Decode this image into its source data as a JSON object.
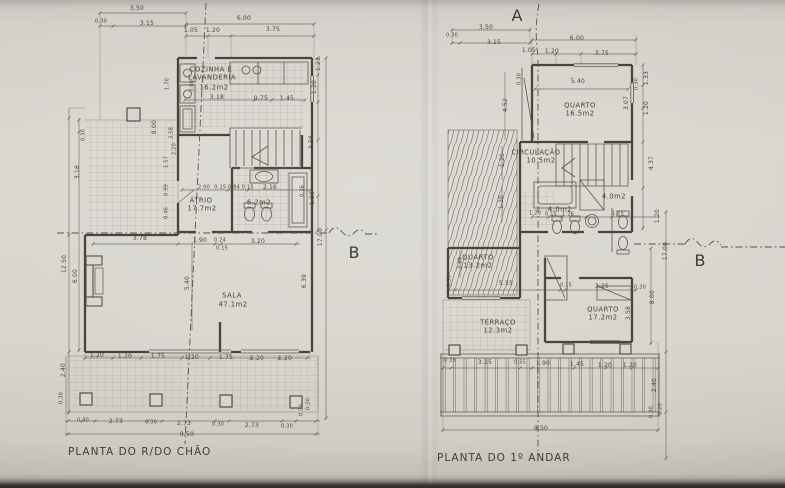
{
  "photo": {
    "paper_color": "#d7d4cd",
    "ink_color": "#4a453d",
    "table_edge_color": "#2b2926"
  },
  "ground_floor": {
    "caption": "PLANTA DO R/DO CHÃO",
    "labels": [
      {
        "t": "3.50",
        "x": 137,
        "y": 9
      },
      {
        "t": "0.30",
        "x": 101,
        "y": 22,
        "c": "sm"
      },
      {
        "t": "3.15",
        "x": 147,
        "y": 24
      },
      {
        "t": "6.00",
        "x": 244,
        "y": 19
      },
      {
        "t": "1.05",
        "x": 191,
        "y": 31
      },
      {
        "t": "1.20",
        "x": 213,
        "y": 31
      },
      {
        "t": "3.75",
        "x": 273,
        "y": 30
      },
      {
        "t": "1.70",
        "x": 168,
        "y": 84,
        "c": "rot sm"
      },
      {
        "t": "3.00",
        "x": 193,
        "y": 86,
        "c": "rot sm"
      },
      {
        "t": "COZINHA E",
        "x": 211,
        "y": 70,
        "c": "room",
        "n": "room-label"
      },
      {
        "t": "LAVANDERIA",
        "x": 212,
        "y": 78,
        "c": "room",
        "n": "room-label"
      },
      {
        "t": "16.2m2",
        "x": 214,
        "y": 88,
        "c": "room",
        "n": "room-area"
      },
      {
        "t": "3.18",
        "x": 217,
        "y": 98
      },
      {
        "t": "0.75",
        "x": 261,
        "y": 99
      },
      {
        "t": "1.45",
        "x": 287,
        "y": 99
      },
      {
        "t": "1.23",
        "x": 319,
        "y": 64,
        "c": "rot"
      },
      {
        "t": "1.20",
        "x": 315,
        "y": 87,
        "c": "rot"
      },
      {
        "t": "0.30",
        "x": 84,
        "y": 135,
        "c": "rot sm"
      },
      {
        "t": "3.18",
        "x": 78,
        "y": 172,
        "c": "rot"
      },
      {
        "t": "8.00",
        "x": 155,
        "y": 127,
        "c": "rot"
      },
      {
        "t": "3.58",
        "x": 172,
        "y": 133,
        "c": "rot sm"
      },
      {
        "t": "2.20",
        "x": 175,
        "y": 149,
        "c": "rot sm"
      },
      {
        "t": "1.57",
        "x": 167,
        "y": 162,
        "c": "rot sm"
      },
      {
        "t": "0.99",
        "x": 167,
        "y": 190,
        "c": "rot sm"
      },
      {
        "t": "0.46",
        "x": 167,
        "y": 213,
        "c": "rot sm"
      },
      {
        "t": "2.00",
        "x": 204,
        "y": 188,
        "c": "sm"
      },
      {
        "t": "0.15 0.84 0.15",
        "x": 234,
        "y": 188,
        "c": "sm"
      },
      {
        "t": "2.16",
        "x": 270,
        "y": 188
      },
      {
        "t": "ÁTRIO",
        "x": 201,
        "y": 201,
        "c": "room",
        "n": "room-label"
      },
      {
        "t": "17.7m2",
        "x": 202,
        "y": 209,
        "c": "room",
        "n": "room-area"
      },
      {
        "t": "6.2m2",
        "x": 259,
        "y": 203,
        "c": "room",
        "n": "room-area"
      },
      {
        "t": "3.58",
        "x": 312,
        "y": 142,
        "c": "rot"
      },
      {
        "t": "0.36",
        "x": 303,
        "y": 191,
        "c": "rot sm"
      },
      {
        "t": "1.20",
        "x": 313,
        "y": 198,
        "c": "rot"
      },
      {
        "t": "17.00",
        "x": 321,
        "y": 237,
        "c": "rot"
      },
      {
        "t": "6.39",
        "x": 305,
        "y": 281,
        "c": "rot"
      },
      {
        "t": "3.78",
        "x": 140,
        "y": 239
      },
      {
        "t": "1.90",
        "x": 200,
        "y": 241
      },
      {
        "t": "0.24",
        "x": 220,
        "y": 241,
        "c": "sm"
      },
      {
        "t": "3.20",
        "x": 258,
        "y": 242
      },
      {
        "t": "0.15",
        "x": 222,
        "y": 249,
        "c": "sm"
      },
      {
        "t": "12.50",
        "x": 65,
        "y": 264,
        "c": "rot"
      },
      {
        "t": "6.00",
        "x": 76,
        "y": 276,
        "c": "rot"
      },
      {
        "t": "5.40",
        "x": 188,
        "y": 283,
        "c": "rot"
      },
      {
        "t": "SALA",
        "x": 232,
        "y": 296,
        "c": "room",
        "n": "room-label"
      },
      {
        "t": "47.1m2",
        "x": 233,
        "y": 305,
        "c": "room",
        "n": "room-area"
      },
      {
        "t": "2.40",
        "x": 64,
        "y": 370,
        "c": "rot"
      },
      {
        "t": "0.30",
        "x": 62,
        "y": 398,
        "c": "rot sm"
      },
      {
        "t": "1.20",
        "x": 97,
        "y": 356
      },
      {
        "t": "1.20",
        "x": 125,
        "y": 357
      },
      {
        "t": "1.75",
        "x": 158,
        "y": 357
      },
      {
        "t": "1.20",
        "x": 192,
        "y": 358
      },
      {
        "t": "1.75",
        "x": 226,
        "y": 358
      },
      {
        "t": "1.20",
        "x": 257,
        "y": 359
      },
      {
        "t": "1.20",
        "x": 285,
        "y": 359
      },
      {
        "t": "0.20",
        "x": 309,
        "y": 404,
        "c": "rot sm"
      },
      {
        "t": "0.30",
        "x": 302,
        "y": 410,
        "c": "rot sm"
      },
      {
        "t": "0.30",
        "x": 83,
        "y": 421,
        "c": "sm"
      },
      {
        "t": "2.73",
        "x": 116,
        "y": 422
      },
      {
        "t": "0.30",
        "x": 151,
        "y": 423,
        "c": "sm"
      },
      {
        "t": "2.73",
        "x": 184,
        "y": 424
      },
      {
        "t": "0.30",
        "x": 218,
        "y": 425,
        "c": "sm"
      },
      {
        "t": "2.73",
        "x": 252,
        "y": 426
      },
      {
        "t": "0.30",
        "x": 287,
        "y": 427,
        "c": "sm"
      },
      {
        "t": "9.50",
        "x": 187,
        "y": 435
      },
      {
        "t": "B",
        "x": 354,
        "y": 253,
        "c": "section",
        "n": "section-marker-b"
      }
    ]
  },
  "first_floor": {
    "caption": "PLANTA DO 1º ANDAR",
    "labels": [
      {
        "t": "A",
        "x": 517,
        "y": 16,
        "c": "section",
        "n": "section-marker-a"
      },
      {
        "t": "3.50",
        "x": 486,
        "y": 28
      },
      {
        "t": "0.30",
        "x": 452,
        "y": 36,
        "c": "sm"
      },
      {
        "t": "3.15",
        "x": 494,
        "y": 43
      },
      {
        "t": "6.00",
        "x": 577,
        "y": 39
      },
      {
        "t": "1.05",
        "x": 529,
        "y": 51
      },
      {
        "t": "1.20",
        "x": 552,
        "y": 52
      },
      {
        "t": "3.75",
        "x": 602,
        "y": 54
      },
      {
        "t": "5.40",
        "x": 578,
        "y": 82
      },
      {
        "t": "0.30",
        "x": 520,
        "y": 79,
        "c": "rot sm"
      },
      {
        "t": "QUARTO",
        "x": 580,
        "y": 106,
        "c": "room",
        "n": "room-label"
      },
      {
        "t": "16.5m2",
        "x": 580,
        "y": 114,
        "c": "room",
        "n": "room-area"
      },
      {
        "t": "1.33",
        "x": 647,
        "y": 78,
        "c": "rot"
      },
      {
        "t": "0.30",
        "x": 637,
        "y": 84,
        "c": "rot sm"
      },
      {
        "t": "3.07",
        "x": 627,
        "y": 103,
        "c": "rot"
      },
      {
        "t": "1.20",
        "x": 647,
        "y": 108,
        "c": "rot"
      },
      {
        "t": "4.52",
        "x": 506,
        "y": 105,
        "c": "rot"
      },
      {
        "t": "CIRCULAÇÃO",
        "x": 536,
        "y": 153,
        "c": "room",
        "n": "room-label"
      },
      {
        "t": "10.5m2",
        "x": 541,
        "y": 161,
        "c": "room",
        "n": "room-area"
      },
      {
        "t": "1.20",
        "x": 503,
        "y": 160,
        "c": "rot"
      },
      {
        "t": "4.37",
        "x": 652,
        "y": 163,
        "c": "rot"
      },
      {
        "t": "1.20",
        "x": 502,
        "y": 202,
        "c": "rot"
      },
      {
        "t": "4.0m2",
        "x": 614,
        "y": 197,
        "c": "room",
        "n": "room-area"
      },
      {
        "t": "4.0m2",
        "x": 560,
        "y": 210,
        "c": "room",
        "n": "room-area"
      },
      {
        "t": "1.20",
        "x": 535,
        "y": 214,
        "c": "sm"
      },
      {
        "t": "0.15",
        "x": 551,
        "y": 215,
        "c": "sm"
      },
      {
        "t": "1.26",
        "x": 568,
        "y": 215,
        "c": "sm"
      },
      {
        "t": "1.55",
        "x": 618,
        "y": 214,
        "c": "sm"
      },
      {
        "t": "1.20",
        "x": 658,
        "y": 216,
        "c": "rot"
      },
      {
        "t": "17.00",
        "x": 666,
        "y": 251,
        "c": "rot"
      },
      {
        "t": "QUARTO",
        "x": 478,
        "y": 258,
        "c": "room",
        "n": "room-label"
      },
      {
        "t": "13.2m2",
        "x": 478,
        "y": 266,
        "c": "room",
        "n": "room-area"
      },
      {
        "t": "2.88",
        "x": 461,
        "y": 263,
        "c": "rot sm"
      },
      {
        "t": "0.30",
        "x": 450,
        "y": 281,
        "c": "rot sm"
      },
      {
        "t": "5.55",
        "x": 506,
        "y": 284
      },
      {
        "t": "0.15",
        "x": 566,
        "y": 286,
        "c": "sm"
      },
      {
        "t": "3.25",
        "x": 602,
        "y": 287
      },
      {
        "t": "0.30",
        "x": 640,
        "y": 288,
        "c": "sm"
      },
      {
        "t": "8.00",
        "x": 653,
        "y": 297,
        "c": "rot"
      },
      {
        "t": "QUARTO",
        "x": 603,
        "y": 310,
        "c": "room",
        "n": "room-label"
      },
      {
        "t": "17.2m2",
        "x": 603,
        "y": 318,
        "c": "room",
        "n": "room-area"
      },
      {
        "t": "3.58",
        "x": 629,
        "y": 313,
        "c": "rot"
      },
      {
        "t": "TERRAÇO",
        "x": 498,
        "y": 323,
        "c": "room",
        "n": "room-label"
      },
      {
        "t": "12.3m2",
        "x": 498,
        "y": 331,
        "c": "room",
        "n": "room-area"
      },
      {
        "t": "0.35",
        "x": 450,
        "y": 361,
        "c": "sm"
      },
      {
        "t": "3.15",
        "x": 485,
        "y": 363
      },
      {
        "t": "0.55",
        "x": 520,
        "y": 363,
        "c": "sm"
      },
      {
        "t": "1.90",
        "x": 543,
        "y": 364
      },
      {
        "t": "1.45",
        "x": 577,
        "y": 365
      },
      {
        "t": "1.20",
        "x": 605,
        "y": 366
      },
      {
        "t": "1.20",
        "x": 630,
        "y": 366
      },
      {
        "t": "2.40",
        "x": 655,
        "y": 385,
        "c": "rot"
      },
      {
        "t": "0.30",
        "x": 652,
        "y": 412,
        "c": "rot sm"
      },
      {
        "t": "0.20",
        "x": 661,
        "y": 409,
        "c": "rot sm"
      },
      {
        "t": "9.50",
        "x": 541,
        "y": 429
      },
      {
        "t": "B",
        "x": 700,
        "y": 261,
        "c": "section",
        "n": "section-marker-b"
      }
    ]
  }
}
